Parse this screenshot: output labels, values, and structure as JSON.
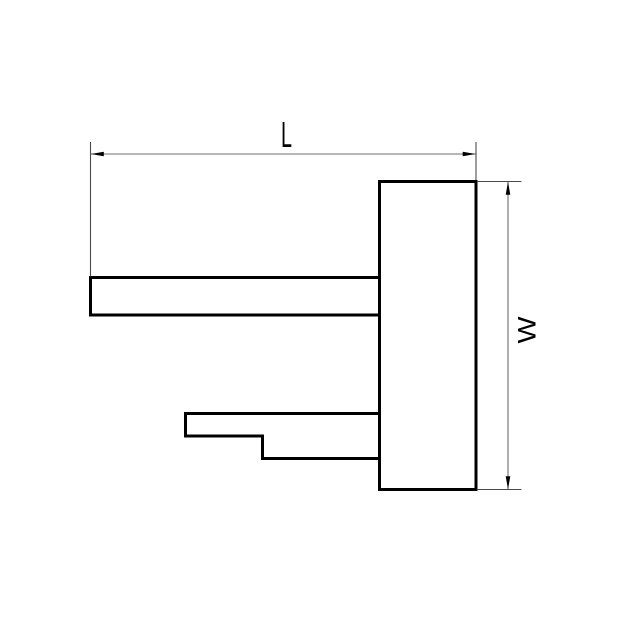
{
  "drawing": {
    "labels": {
      "length": "L",
      "width": "W"
    },
    "colors": {
      "outline": "#000000",
      "dimension_line": "#6e6e6e",
      "extension_line": "#4a4a4a",
      "arrow": "#000000",
      "text": "#000000",
      "background": "#ffffff"
    }
  }
}
